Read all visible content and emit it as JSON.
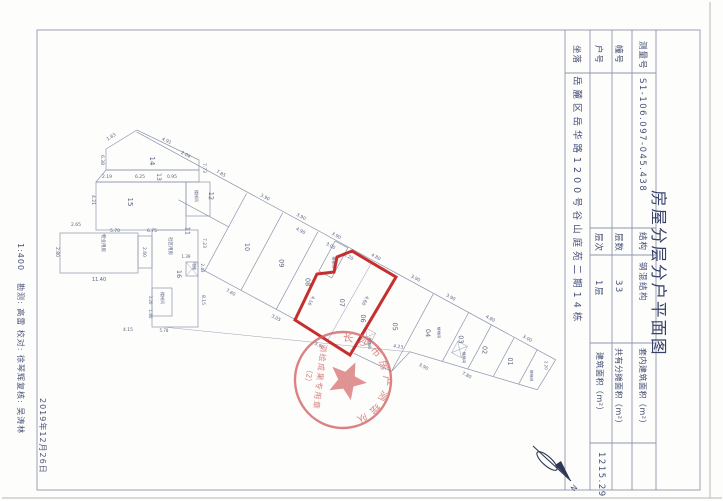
{
  "title": "房屋分层分户平面图",
  "margin": {
    "scale": "1:400",
    "credits": "勘测: 高雷 校对: 徐琴辉复核: 吴涛林",
    "date": "2019年12月26日"
  },
  "table": {
    "survey_no": {
      "label": "测量号",
      "value": "S1-106.097-045.438"
    },
    "building_no": {
      "label": "幢号",
      "value": ""
    },
    "unit_no": {
      "label": "户号",
      "value": ""
    },
    "location": {
      "label": "坐落",
      "value": "岳麓区岳华路1200号谷山庭苑二期14栋"
    },
    "structure": {
      "label": "结构",
      "value": "钢混结构"
    },
    "floors": {
      "label": "层数",
      "value": "33"
    },
    "floor": {
      "label": "层次",
      "value": "1层"
    },
    "inner_area": {
      "label": "套内建筑面积（m²）",
      "value": ""
    },
    "shared_area": {
      "label": "共有分摊面积（m²）",
      "value": ""
    },
    "total_area": {
      "label": "建筑面积（m²）",
      "value": "1215.29"
    }
  },
  "stamp": {
    "ring_text": "长沙市房产测绘队",
    "line1": "测绘成果专用章",
    "line2": "（2）"
  },
  "north": {
    "label": "N"
  },
  "plan": {
    "labels": [
      {
        "t": "14",
        "x": 150,
        "y": 161,
        "r": 90,
        "s": 7
      },
      {
        "t": "13",
        "x": 157,
        "y": 177,
        "r": 90,
        "s": 6
      },
      {
        "t": "15",
        "x": 128,
        "y": 202,
        "r": 90,
        "s": 7
      },
      {
        "t": "社区用房",
        "x": 169,
        "y": 246,
        "r": 90,
        "s": 4.5
      },
      {
        "t": "16",
        "x": 177,
        "y": 274,
        "r": 90,
        "s": 6.5
      },
      {
        "t": "物业用房",
        "x": 102,
        "y": 243,
        "r": 90,
        "s": 4.5
      },
      {
        "t": "楼梯间",
        "x": 195,
        "y": 196,
        "r": 90,
        "s": 4
      },
      {
        "t": "楼梯间",
        "x": 161,
        "y": 298,
        "r": 90,
        "s": 4
      },
      {
        "t": "电梯",
        "x": 193,
        "y": 266,
        "r": 90,
        "s": 3.8
      },
      {
        "t": "2.19",
        "x": 107,
        "y": 178,
        "r": 0,
        "s": 4.5
      },
      {
        "t": "6.25",
        "x": 140,
        "y": 178,
        "r": 0,
        "s": 4.5
      },
      {
        "t": "0.95",
        "x": 172,
        "y": 178,
        "r": 0,
        "s": 4.5
      },
      {
        "t": "1.63",
        "x": 112,
        "y": 138,
        "r": -33,
        "s": 4.5
      },
      {
        "t": "4.91",
        "x": 166,
        "y": 142,
        "r": 25,
        "s": 4.5
      },
      {
        "t": "6.38",
        "x": 101,
        "y": 160,
        "r": 90,
        "s": 4.5
      },
      {
        "t": "7.73",
        "x": 203,
        "y": 168,
        "r": 90,
        "s": 4.5
      },
      {
        "t": "4.21",
        "x": 92,
        "y": 200,
        "r": 90,
        "s": 4.5
      },
      {
        "t": "2.65",
        "x": 76,
        "y": 226,
        "r": 0,
        "s": 4.5
      },
      {
        "t": "5.70",
        "x": 115,
        "y": 232,
        "r": 0,
        "s": 4.5
      },
      {
        "t": "6.75",
        "x": 152,
        "y": 232,
        "r": 0,
        "s": 4.5
      },
      {
        "t": "11.40",
        "x": 99,
        "y": 281,
        "r": 0,
        "s": 5
      },
      {
        "t": "2.80",
        "x": 56,
        "y": 252,
        "r": 90,
        "s": 4.5
      },
      {
        "t": "2.60",
        "x": 143,
        "y": 252,
        "r": 90,
        "s": 4.5
      },
      {
        "t": "7.23",
        "x": 203,
        "y": 243,
        "r": 90,
        "s": 4.5
      },
      {
        "t": "8.15",
        "x": 202,
        "y": 300,
        "r": 90,
        "s": 4.5
      },
      {
        "t": "4.15",
        "x": 128,
        "y": 331,
        "r": 0,
        "s": 4.5
      },
      {
        "t": "3.20",
        "x": 149,
        "y": 300,
        "r": 90,
        "s": 4
      },
      {
        "t": "1.80",
        "x": 149,
        "y": 314,
        "r": 90,
        "s": 4
      },
      {
        "t": "5.78",
        "x": 164,
        "y": 332,
        "r": 0,
        "s": 4
      },
      {
        "t": "1.39",
        "x": 186,
        "y": 258,
        "r": 0,
        "s": 4
      },
      {
        "t": "2.43",
        "x": 201,
        "y": 268,
        "r": 90,
        "s": 4
      },
      {
        "t": "4.23",
        "x": 398,
        "y": 348,
        "r": 8,
        "s": 4.5
      },
      {
        "t": "4.90",
        "x": 300,
        "y": 232,
        "r": 28,
        "s": 4.5
      },
      {
        "t": "3.00",
        "x": 330,
        "y": 247,
        "r": 28,
        "s": 4.5
      },
      {
        "t": "1.20",
        "x": 348,
        "y": 258,
        "r": 28,
        "s": 4.5
      },
      {
        "t": "4.16",
        "x": 310,
        "y": 300,
        "r": 118,
        "s": 4.5
      },
      {
        "t": "4.60",
        "x": 364,
        "y": 300,
        "r": 118,
        "s": 4.5
      }
    ],
    "strip_labels": [
      {
        "t": "12",
        "x": 30,
        "y": 20,
        "r": 62,
        "s": 6.5
      },
      {
        "t": "11",
        "x": 26,
        "y": 62,
        "r": 62,
        "s": 6.5
      },
      {
        "t": "10",
        "x": 86,
        "y": 48,
        "r": 62,
        "s": 6.5
      },
      {
        "t": "09",
        "x": 124,
        "y": 46,
        "r": 62,
        "s": 6.5
      },
      {
        "t": "08",
        "x": 156,
        "y": 50,
        "r": 62,
        "s": 6.5
      },
      {
        "t": "07",
        "x": 196,
        "y": 52,
        "r": 62,
        "s": 6.5
      },
      {
        "t": "06",
        "x": 222,
        "y": 56,
        "r": 62,
        "s": 6.5
      },
      {
        "t": "05",
        "x": 254,
        "y": 48,
        "r": 62,
        "s": 6.5
      },
      {
        "t": "04",
        "x": 286,
        "y": 38,
        "r": 62,
        "s": 6.5
      },
      {
        "t": "03",
        "x": 318,
        "y": 28,
        "r": 62,
        "s": 6.5
      },
      {
        "t": "02",
        "x": 344,
        "y": 26,
        "r": 62,
        "s": 6.5
      },
      {
        "t": "01",
        "x": 372,
        "y": 24,
        "r": 62,
        "s": 6.5
      },
      {
        "t": "楼梯间",
        "x": 170,
        "y": 20,
        "r": 62,
        "s": 3.8
      },
      {
        "t": "楼梯间",
        "x": 240,
        "y": 74,
        "r": 62,
        "s": 3.8
      },
      {
        "t": "楼梯间",
        "x": 296,
        "y": 32,
        "r": 62,
        "s": 3.8
      },
      {
        "t": "楼梯间",
        "x": 330,
        "y": 42,
        "r": 62,
        "s": 3.8
      },
      {
        "t": "楼梯间",
        "x": 398,
        "y": 26,
        "r": 62,
        "s": 3.8
      },
      {
        "t": "2.04",
        "x": -10,
        "y": -4,
        "r": 0,
        "s": 4.5
      },
      {
        "t": "7.85",
        "x": 30,
        "y": -4,
        "r": 0,
        "s": 4.5
      },
      {
        "t": "3.90",
        "x": 80,
        "y": -4,
        "r": 0,
        "s": 4.5
      },
      {
        "t": "3.90",
        "x": 121,
        "y": -4,
        "r": 0,
        "s": 4.5
      },
      {
        "t": "3.90",
        "x": 161,
        "y": -4,
        "r": 0,
        "s": 4.5
      },
      {
        "t": "4.80",
        "x": 206,
        "y": -4,
        "r": 0,
        "s": 4.5
      },
      {
        "t": "3.90",
        "x": 251,
        "y": -4,
        "r": 0,
        "s": 4.5
      },
      {
        "t": "3.90",
        "x": 291,
        "y": -4,
        "r": 0,
        "s": 4.5
      },
      {
        "t": "4.80",
        "x": 336,
        "y": -4,
        "r": 0,
        "s": 4.5
      },
      {
        "t": "3.00",
        "x": 378,
        "y": -4,
        "r": 0,
        "s": 4.5
      },
      {
        "t": "2.20",
        "x": 406,
        "y": 10,
        "r": 62,
        "s": 4
      },
      {
        "t": "7.60",
        "x": 95,
        "y": 96,
        "r": 0,
        "s": 4.5
      },
      {
        "t": "3.05",
        "x": 147,
        "y": 97,
        "r": 0,
        "s": 4.5
      },
      {
        "t": "3.90",
        "x": 198,
        "y": 101,
        "r": 0,
        "s": 4.5
      },
      {
        "t": "3.90",
        "x": 300,
        "y": 70,
        "r": 0,
        "s": 4.5
      },
      {
        "t": "7.80",
        "x": 342,
        "y": 57,
        "r": 0,
        "s": 4.5
      }
    ]
  }
}
